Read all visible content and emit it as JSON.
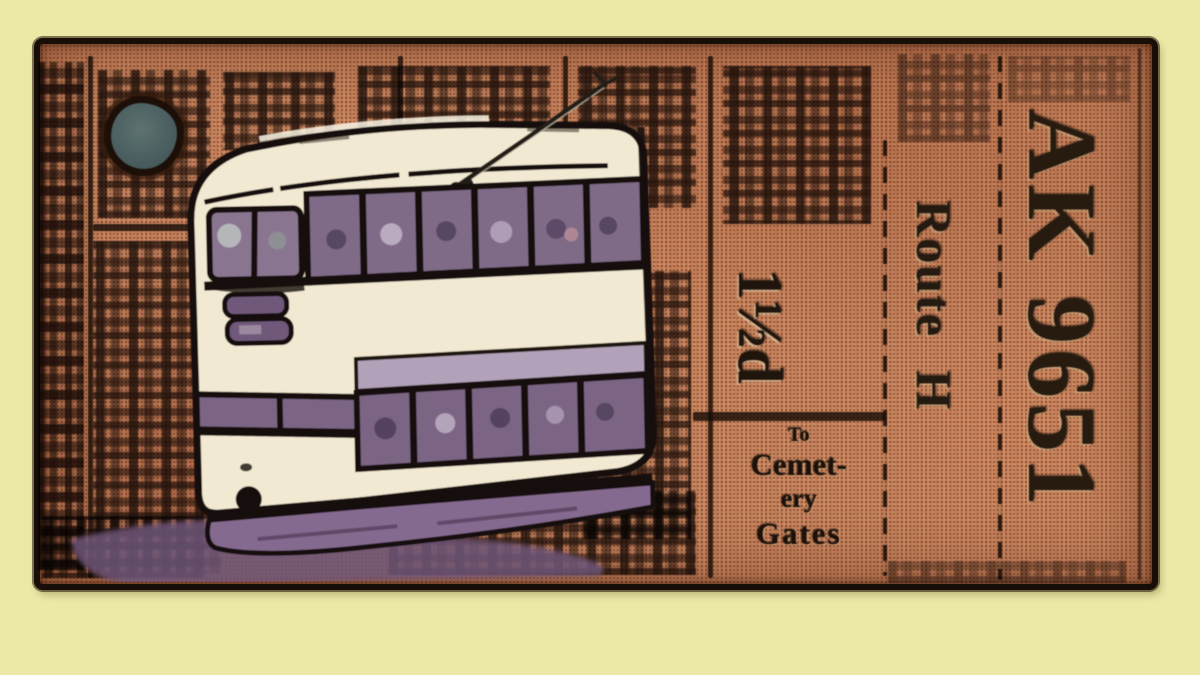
{
  "scene": {
    "kind": "stylised poster artwork",
    "subject": "cream double-decker tram in front of a vintage orange tram ticket"
  },
  "ticket": {
    "serial": "AK 9651",
    "route": "Route H",
    "fare": "1½d",
    "destination": {
      "line1": "To",
      "line2": "Cemet-",
      "line3": "ery",
      "line4": "Gates"
    }
  },
  "colors": {
    "page_background": "#ece9a7",
    "ticket_base": "#c8845d",
    "ink": "#1c110a",
    "tram_cream": "#f2e9d2",
    "tram_window_purple": "#7f6a87",
    "tram_skirt_purple": "#856a90",
    "punch_hole": "#546567"
  }
}
